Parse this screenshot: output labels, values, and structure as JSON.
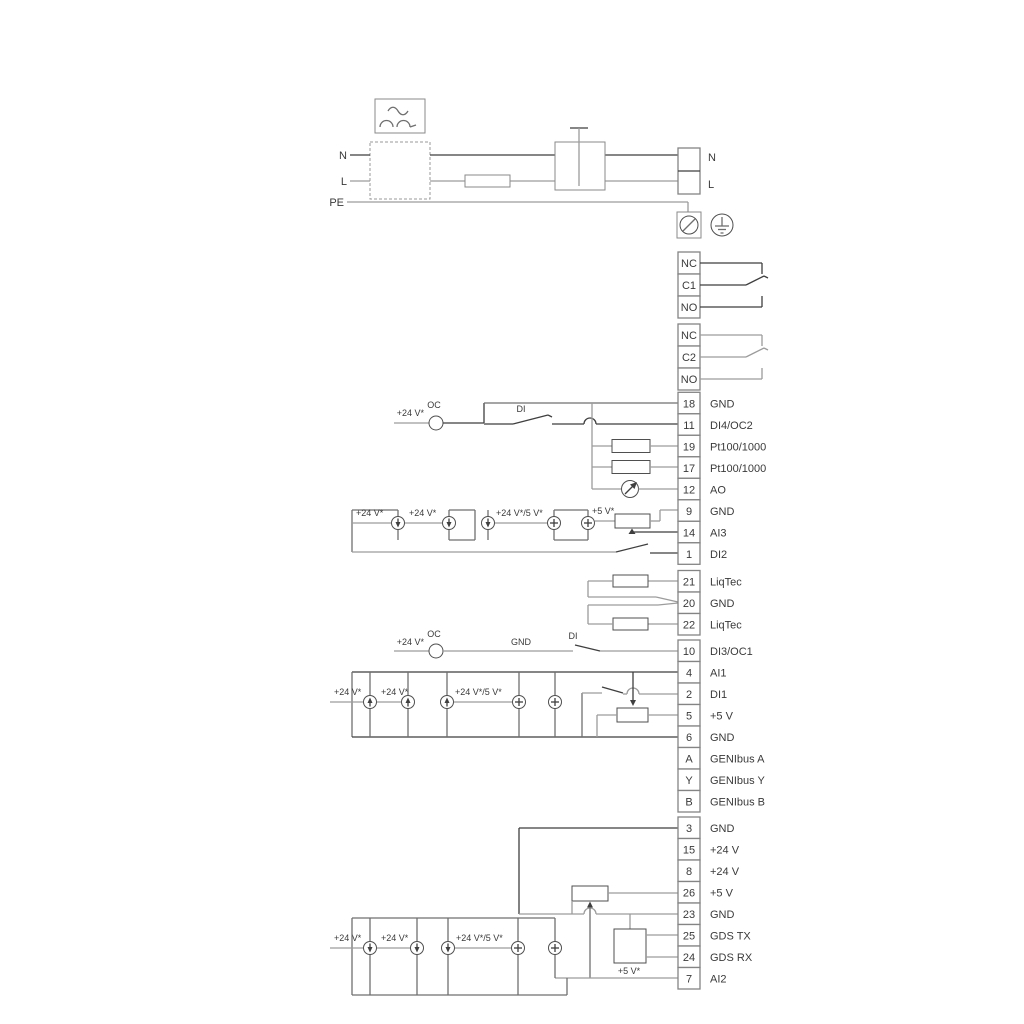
{
  "diagram_title": "Pump controller wiring diagram",
  "colors": {
    "wire_dark": "#3f3f3f",
    "wire_light": "#9c9c9c",
    "component": "#4f4f4f",
    "text": "#3a3a3a"
  },
  "power": {
    "n_left": "N",
    "l_left": "L",
    "pe": "PE",
    "n_right": "N",
    "l_right": "L"
  },
  "relays": {
    "r1": [
      "NC",
      "C1",
      "NO"
    ],
    "r2": [
      "NC",
      "C2",
      "NO"
    ]
  },
  "groups": {
    "a": [
      {
        "n": "18",
        "t": "GND"
      },
      {
        "n": "11",
        "t": "DI4/OC2"
      },
      {
        "n": "19",
        "t": "Pt100/1000"
      },
      {
        "n": "17",
        "t": "Pt100/1000"
      },
      {
        "n": "12",
        "t": "AO"
      },
      {
        "n": "9",
        "t": "GND"
      },
      {
        "n": "14",
        "t": "AI3"
      },
      {
        "n": "1",
        "t": "DI2"
      }
    ],
    "b": [
      {
        "n": "21",
        "t": "LiqTec"
      },
      {
        "n": "20",
        "t": "GND"
      },
      {
        "n": "22",
        "t": "LiqTec"
      }
    ],
    "c": [
      {
        "n": "10",
        "t": "DI3/OC1"
      },
      {
        "n": "4",
        "t": "AI1"
      },
      {
        "n": "2",
        "t": "DI1"
      },
      {
        "n": "5",
        "t": "+5 V"
      },
      {
        "n": "6",
        "t": "GND"
      },
      {
        "n": "A",
        "t": "GENIbus A"
      },
      {
        "n": "Y",
        "t": "GENIbus Y"
      },
      {
        "n": "B",
        "t": "GENIbus B"
      }
    ],
    "d": [
      {
        "n": "3",
        "t": "GND"
      },
      {
        "n": "15",
        "t": "+24 V"
      },
      {
        "n": "8",
        "t": "+24 V"
      },
      {
        "n": "26",
        "t": "+5 V"
      },
      {
        "n": "23",
        "t": "GND"
      },
      {
        "n": "25",
        "t": "GDS TX"
      },
      {
        "n": "24",
        "t": "GDS RX"
      },
      {
        "n": "7",
        "t": "AI2"
      }
    ]
  },
  "ann": {
    "v24": "+24 V*",
    "v24v5": "+24 V*/5 V*",
    "v5": "+5 V*",
    "oc": "OC",
    "di": "DI",
    "gnd": "GND"
  }
}
